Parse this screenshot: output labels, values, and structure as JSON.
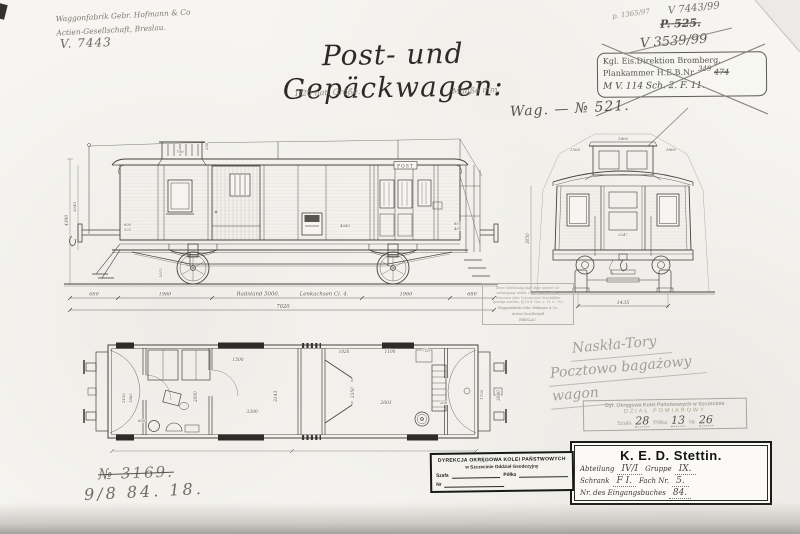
{
  "header": {
    "maker_line1": "Waggonfabrik Gebr. Hofmann & Co",
    "maker_line2": "Actien-Gesellschaft, Breslau.",
    "maker_number": "V. 7443",
    "filing_small": "p. 1365/97",
    "filing_number": "V 7443/99",
    "filing_crossed": "P. 525.",
    "filing_crossed2": "V 3539/99",
    "title": "Post- und Gepäckwagen:",
    "scale_note": "1/20 nat. Größe.",
    "units_note": "Maaße mm.",
    "wagon_note": "Wag. — № 521."
  },
  "stamp_bromberg": {
    "line1": "Kgl. Eis.Direktion Bromberg.",
    "line2_label": "Plankammer H.E.B.Nr.",
    "line2_value": "474",
    "line2_over": "349",
    "line3": "M V. 114   Sch. 2.   F. 11."
  },
  "side_view": {
    "sign": "POST",
    "dims": {
      "lookout_w": "700",
      "lookout_h": "250",
      "height_left": "4300",
      "height_inner": "3045",
      "d600": "600",
      "d522": "522",
      "d1012": "1012",
      "d4043": "4043",
      "d850": "850",
      "d400": "400"
    },
    "bottom": {
      "b1": "680",
      "b2": "1960",
      "label1": "Radstand 5000,",
      "label2": "Lenkachsen Cl. 4.",
      "b3": "1960",
      "b4": "680",
      "total": "7020"
    }
  },
  "end_view": {
    "d1500": "1500",
    "d1400": "1400",
    "d1800": "1800",
    "d5247": "5247",
    "gauge": "1435",
    "height": "3050"
  },
  "plan_view": {
    "door": "1500",
    "luggage": "3300",
    "width": "3143",
    "post_room": "2000",
    "a2450": "2450",
    "a1865": "1865",
    "a600": "600",
    "v1020": "1020",
    "v1100": "1100",
    "v710": "710",
    "v2350": "2350",
    "room": "2603",
    "a200": "200",
    "a1700": "1700",
    "a3080": "3080"
  },
  "hofmann_stamp": {
    "notice1": "Diese Zeichnung darf ohne unsere Ge-",
    "notice2": "nehmigung weder copirt noch dritten",
    "notice3": "Personen oder Concurrenz-Geschäften",
    "notice4": "gezeigt werden. (§ 18 d. Ges. v. 11. 6. 70.)",
    "firm1": "Waggonfabrik Gebr. Hofmann & Co.",
    "firm2": "Actien-Gesellschaft",
    "firm3": "BRESLAU."
  },
  "polish_note": {
    "line1": "Naskła-Tory",
    "line2": "Pocztowo bagażowy",
    "line3": "wagon"
  },
  "stamp_pomiarowy": {
    "line1": "Dyr. Okręgowa Kolei Państwowych w Szczecinie",
    "line2": "DZIAŁ POMIAROWY",
    "szafa_label": "Szafa",
    "szafa_value": "28",
    "polka_label": "Półka",
    "polka_value": "13",
    "nr_label": "№",
    "nr_value": "26"
  },
  "stamp_ked": {
    "title": "K. E. D. Stettin.",
    "abteilung_label": "Abteilung",
    "abteilung_value": "IV/I",
    "gruppe_label": "Gruppe",
    "gruppe_value": "IX.",
    "schrank_label": "Schrank",
    "schrank_value": "F I.",
    "fach_label": "Fach Nr.",
    "fach_value": "5.",
    "eingang_label": "Nr. des Eingangsbuches",
    "eingang_value": "84."
  },
  "stamp_geodezyjny": {
    "line1": "DYREKCJA OKRĘGOWA KOLEI PAŃSTWOWYCH",
    "line2": "w Szczecinie Oddział Geodezyjny",
    "szafa_label": "Szafa",
    "polka_label": "Półka",
    "nr_label": "Nr"
  },
  "footer_notes": {
    "crossed": "№ 3169.",
    "date_note": "9/8 84.  18."
  }
}
